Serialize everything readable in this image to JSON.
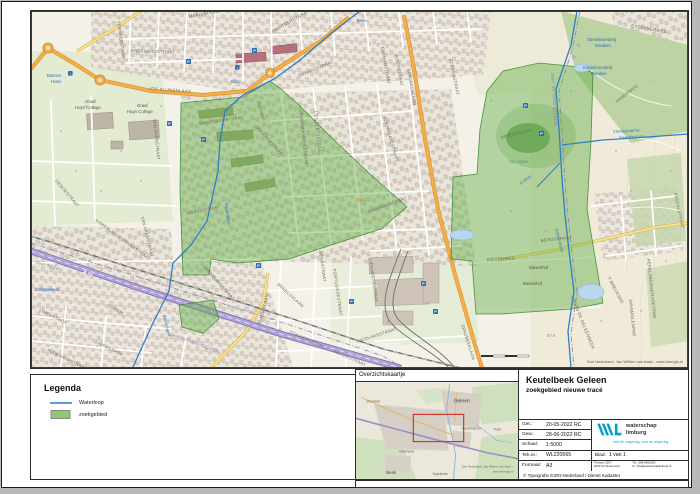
{
  "legend": {
    "title": "Legenda",
    "items": [
      {
        "label": "Waterloop",
        "type": "line",
        "color": "#2f7fc4"
      },
      {
        "label": "zoekgebied",
        "type": "fill",
        "color": "#8fc873"
      }
    ]
  },
  "overview_map": {
    "title": "Overzichtskaartje",
    "extent_color": "#cf3b2b",
    "labels": [
      {
        "t": "Geleen",
        "x": 97,
        "y": 20,
        "s": 5,
        "cls": "town"
      },
      {
        "t": "Chemelot",
        "x": 10,
        "y": 20,
        "s": 3.2,
        "cls": "small"
      },
      {
        "t": "Sweikhuizen",
        "x": 105,
        "y": 47,
        "s": 3.4,
        "cls": "small"
      },
      {
        "t": "Puth",
        "x": 137,
        "y": 48,
        "s": 3.4,
        "cls": "small"
      },
      {
        "t": "Neerbeek",
        "x": 43,
        "y": 70,
        "s": 3.4,
        "cls": "small"
      },
      {
        "t": "Spaubeek",
        "x": 76,
        "y": 92,
        "s": 3.4,
        "cls": "small"
      },
      {
        "t": "Beek",
        "x": 30,
        "y": 91,
        "s": 4.4,
        "cls": "town"
      },
      {
        "t": "Esri Nederland, Jan Willem van Aalst -",
        "x": 156,
        "y": 85,
        "s": 3,
        "a": "end",
        "cls": "attr"
      },
      {
        "t": "www.imergis.nl",
        "x": 156,
        "y": 89.5,
        "s": 3,
        "a": "end",
        "cls": "attr"
      }
    ]
  },
  "titleblock": {
    "title": "Keutelbeek Geleen",
    "subtitle": "zoekgebied nieuwe tracé",
    "rows": [
      {
        "label": "Get.:",
        "value": "20-05-2022 RC"
      },
      {
        "label": "Gew.:",
        "value": "28-06-2022 RC"
      },
      {
        "label": "Schaal:",
        "value": "1:5000"
      },
      {
        "label": "Tek.nr.:",
        "value": "WL220565"
      },
      {
        "label": "Formaat:",
        "value": "A3"
      }
    ],
    "blad_label": "Blad:",
    "blad_value": "1 van 1",
    "copyright": "© Topografie ESRI-Nederland / Dienst Kadaster",
    "org": {
      "name1": "waterschap",
      "name2": "limburg",
      "tagline": "met de omgeving, voor de omgeving",
      "address_l1": "Postbus 2207",
      "address_l2": "6040 CC Roermond",
      "tel": "Tel.: 088-8890100",
      "email": "E.: info@waterschaplimburg.nl",
      "brand_color": "#00a1c5"
    }
  },
  "footer_path": "Pad- en documentnaam: Z:\\WSL\\A_Prog_Watersystemen_en_keten\\Voorbereiding\\Verbetering\\Keutelbeek\\WL-220565\\WL220565\\WL-220565.apm",
  "map": {
    "attribution": "Esri Nederland, Jan Willem van Aalst - www.imergis.nl",
    "icons": {
      "parking": {
        "glyph": "P",
        "color": "#2a6db8",
        "positions": [
          [
            221,
            37
          ],
          [
            155,
            48
          ],
          [
            136,
            110
          ],
          [
            170,
            126
          ],
          [
            225,
            252
          ],
          [
            318,
            288
          ],
          [
            390,
            270
          ],
          [
            402,
            298
          ],
          [
            492,
            92
          ],
          [
            508,
            120
          ]
        ]
      },
      "info": {
        "glyph": "i",
        "color": "#2a6db8",
        "positions": [
          [
            204,
            54
          ],
          [
            37,
            60
          ]
        ]
      },
      "star": {
        "glyph": "☆",
        "color": "#2a6db8",
        "positions": [
          [
            545,
            36
          ],
          [
            540,
            48
          ]
        ]
      }
    },
    "labels": [
      {
        "t": "MARISSTRAAT",
        "x": 158,
        "y": 7,
        "r": -10
      },
      {
        "t": "BREITNERSTRAAT",
        "x": 242,
        "y": 22,
        "r": -30
      },
      {
        "t": "EBERNARDSTRAAT",
        "x": 100,
        "y": 41,
        "r": 2
      },
      {
        "t": "JOS KLIJNENLAAN",
        "x": 118,
        "y": 79,
        "r": 4,
        "s": 5
      },
      {
        "t": "VERMEERSTRAAT",
        "x": 86,
        "y": 10,
        "r": 82,
        "s": 3.8
      },
      {
        "t": "DUNANTSTRAAT",
        "x": 268,
        "y": 66,
        "r": -22,
        "s": 3.8
      },
      {
        "t": "EYKMANSTRAAT",
        "x": 350,
        "y": 36,
        "r": 80,
        "s": 3.8
      },
      {
        "t": "KOCHSTRAAT",
        "x": 364,
        "y": 44,
        "r": 80,
        "s": 3.8
      },
      {
        "t": "BOERHAAVESTRAAT",
        "x": 352,
        "y": 106,
        "r": 74,
        "s": 3.8
      },
      {
        "t": "SPAUBEEKLAAN",
        "x": 376,
        "y": 58,
        "r": 80,
        "s": 4.8
      },
      {
        "t": "SPAUBEEKLAAN",
        "x": 430,
        "y": 314,
        "r": 72,
        "s": 4.8
      },
      {
        "t": "STEGENSTRAAT",
        "x": 418,
        "y": 48,
        "r": 78,
        "s": 3.8
      },
      {
        "t": "EYSDENERWEG",
        "x": 600,
        "y": 16,
        "r": 10
      },
      {
        "t": "VAN AKENSTRAAT",
        "x": 122,
        "y": 108,
        "r": 84,
        "s": 3.8
      },
      {
        "t": "VAN AKENSTRAAT",
        "x": 110,
        "y": 206,
        "r": 76,
        "s": 3.8
      },
      {
        "t": "WAGENAARSTRAAT",
        "x": 168,
        "y": 114,
        "r": -8
      },
      {
        "t": "KAMERLINGH ONNESSTRAAT",
        "x": 64,
        "y": 210,
        "r": 36,
        "s": 3.8
      },
      {
        "t": "DEBIJESTRAAT",
        "x": 24,
        "y": 170,
        "r": 50,
        "s": 3.8
      },
      {
        "t": "NOBELSTRAAT",
        "x": 156,
        "y": 204,
        "r": -12,
        "s": 3.8
      },
      {
        "t": "LUXEMBURGSTRAAT",
        "x": 170,
        "y": 254,
        "r": 48,
        "s": 3.8
      },
      {
        "t": "LEEUWERIKHOEKSTRAAT",
        "x": 268,
        "y": 96,
        "r": 84,
        "s": 3.6
      },
      {
        "t": "LIENAERTSSTRAAT",
        "x": 283,
        "y": 100,
        "r": 84,
        "s": 3.6
      },
      {
        "t": "LIENAERTSSTRAAT",
        "x": 338,
        "y": 248,
        "r": 82,
        "s": 3.8
      },
      {
        "t": "ZUIDHOF",
        "x": 226,
        "y": 90,
        "r": 75,
        "s": 3.8
      },
      {
        "t": "OUDEHOFSTRAAT",
        "x": 224,
        "y": 116,
        "r": 48,
        "s": 3.6
      },
      {
        "t": "BARBARASTRAAT",
        "x": 338,
        "y": 202,
        "r": -20
      },
      {
        "t": "BENELUXLAAN",
        "x": 246,
        "y": 274,
        "r": 42
      },
      {
        "t": "EUROPALAAN",
        "x": 230,
        "y": 314,
        "r": -76
      },
      {
        "t": "GENKSTRAAT",
        "x": 288,
        "y": 240,
        "r": 82,
        "s": 3.8
      },
      {
        "t": "PORTUGESESTRAAT",
        "x": 302,
        "y": 258,
        "r": 82,
        "s": 3.6
      },
      {
        "t": "BERGSTRAAT",
        "x": 510,
        "y": 231,
        "r": -6,
        "s": 4.8
      },
      {
        "t": "BIESENWEG",
        "x": 456,
        "y": 250,
        "r": -3,
        "s": 4.8
      },
      {
        "t": "HABERWEG",
        "x": 586,
        "y": 92,
        "r": -38
      },
      {
        "t": "PASCALSTRAAT",
        "x": 643,
        "y": 182,
        "r": 78,
        "s": 3.6
      },
      {
        "t": "STIKKERSTRAAT",
        "x": 258,
        "y": 322,
        "r": 24,
        "s": 3.8
      },
      {
        "t": "BELGIËSTRAAT",
        "x": 302,
        "y": 341,
        "r": 24,
        "s": 3.8
      },
      {
        "t": "LIMPENSHOF",
        "x": 8,
        "y": 300,
        "r": 26,
        "s": 3.8
      },
      {
        "t": "LIMPENSHOF",
        "x": 64,
        "y": 332,
        "r": 26,
        "s": 3.8
      },
      {
        "t": "ALDENHOFSTRAAT",
        "x": 16,
        "y": 340,
        "r": 26,
        "s": 3.8
      },
      {
        "t": "TOMEIK",
        "x": 76,
        "y": 296,
        "r": 26,
        "s": 3.8
      },
      {
        "t": "'T BREUKSKE",
        "x": 576,
        "y": 266,
        "r": 62,
        "s": 3.8
      },
      {
        "t": "PEPELSBERGERVOETPAD",
        "x": 616,
        "y": 248,
        "r": 84,
        "s": 3.4
      },
      {
        "t": "JANSMOLENPAD",
        "x": 598,
        "y": 288,
        "r": 84,
        "s": 3.6
      },
      {
        "t": "LANGS DE GELEENBEEK",
        "x": 540,
        "y": 286,
        "r": 68,
        "s": 3.6
      },
      {
        "t": "NICOLAASSTRAAT",
        "x": 326,
        "y": 332,
        "r": -18,
        "s": 3.8
      },
      {
        "t": "DRIEPOELPAD",
        "x": 470,
        "y": 128,
        "r": -14,
        "s": 3.6
      },
      {
        "t": "Keutelbeek",
        "x": 194,
        "y": 192,
        "r": 84,
        "cls": "water"
      },
      {
        "t": "Keutelbeek",
        "x": 132,
        "y": 304,
        "r": 78,
        "s": 3.2,
        "cls": "water"
      },
      {
        "t": "Geleenbeek",
        "x": 524,
        "y": 218,
        "r": 76,
        "cls": "water"
      },
      {
        "t": "Vloedgraaf te",
        "x": 582,
        "y": 122,
        "r": -3,
        "cls": "water"
      },
      {
        "t": "Sweikhuizen",
        "x": 588,
        "y": 128,
        "r": -3,
        "cls": "water"
      },
      {
        "t": "A.05zv",
        "x": 490,
        "y": 174,
        "r": -38,
        "cls": "water"
      },
      {
        "t": "Vis vijver",
        "x": 478,
        "y": 152,
        "s": 4.6,
        "cls": "green"
      },
      {
        "t": "Bastion",
        "x": 16,
        "y": 66,
        "cls": "poi"
      },
      {
        "t": "Hotel",
        "x": 20,
        "y": 72,
        "cls": "poi"
      },
      {
        "t": "Esso",
        "x": 200,
        "y": 72,
        "s": 3.4,
        "cls": "poi"
      },
      {
        "t": "Esso",
        "x": 326,
        "y": 11,
        "s": 3.4,
        "cls": "poi"
      },
      {
        "t": "Streekboerderij",
        "x": 556,
        "y": 30,
        "cls": "poi"
      },
      {
        "t": "Daniken",
        "x": 564,
        "y": 36,
        "cls": "poi"
      },
      {
        "t": "Kinderboerderij",
        "x": 552,
        "y": 58,
        "cls": "poi"
      },
      {
        "t": "Daniken",
        "x": 560,
        "y": 64,
        "cls": "poi"
      },
      {
        "t": "Callistuskerk",
        "x": 4,
        "y": 280,
        "s": 3.8,
        "cls": "poi"
      },
      {
        "t": "Graaf",
        "x": 54,
        "y": 92,
        "cls": "area"
      },
      {
        "t": "Huyn College",
        "x": 44,
        "y": 98,
        "cls": "area"
      },
      {
        "t": "Graaf",
        "x": 106,
        "y": 96,
        "cls": "area"
      },
      {
        "t": "Huyn College",
        "x": 96,
        "y": 102,
        "cls": "area"
      },
      {
        "t": "Biesenhof",
        "x": 498,
        "y": 258,
        "s": 3.4,
        "cls": "area"
      },
      {
        "t": "Biesenhof",
        "x": 492,
        "y": 274,
        "s": 3.4,
        "cls": "area"
      },
      {
        "t": "6164",
        "x": 326,
        "y": 190,
        "s": 3.8,
        "cls": "orange"
      },
      {
        "t": "57.9",
        "x": 516,
        "y": 326,
        "s": 3.8,
        "cls": "elev"
      },
      {
        "t": "6",
        "x": 356,
        "y": 312,
        "s": 3.6,
        "cls": "elev"
      },
      {
        "t": "Gem. BEEK",
        "x": 4,
        "y": 252,
        "r": 18,
        "cls": "muni"
      },
      {
        "t": "Gem. SITTARD-GELEEN",
        "x": 138,
        "y": 324,
        "r": 20,
        "cls": "muni"
      },
      {
        "t": "Gem. SITTARD-GELEEN",
        "x": 520,
        "y": 62,
        "r": 86,
        "cls": "muni"
      },
      {
        "t": "A 76",
        "x": 52,
        "y": 262,
        "r": 20,
        "s": 4.5,
        "cls": "mot"
      },
      {
        "t": "A 76",
        "x": 84,
        "y": 276,
        "r": 20,
        "s": 4.5,
        "cls": "mot"
      },
      {
        "t": "Esri Nederland, Jan Willem van Aalst - www.imergis.nl",
        "x": 652,
        "y": 352,
        "a": "end",
        "cls": "attr"
      }
    ]
  }
}
